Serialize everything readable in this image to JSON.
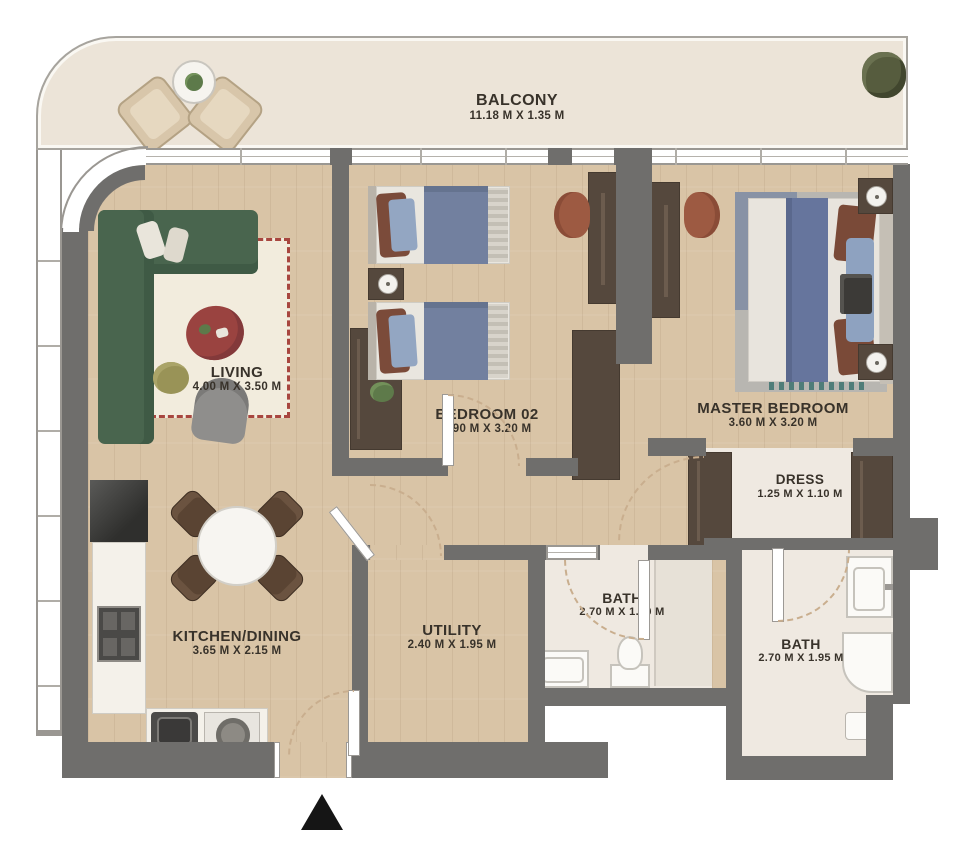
{
  "rooms": {
    "balcony": {
      "name": "BALCONY",
      "dims": "11.18 M X 1.35 M"
    },
    "living": {
      "name": "LIVING",
      "dims": "4.00 M X 3.50 M"
    },
    "bedroom02": {
      "name": "BEDROOM 02",
      "dims": "3.90 M X 3.20 M"
    },
    "master": {
      "name": "MASTER BEDROOM",
      "dims": "3.60 M X 3.20 M"
    },
    "dress": {
      "name": "DRESS",
      "dims": "1.25 M X 1.10 M"
    },
    "bath1": {
      "name": "BATH",
      "dims": "2.70 M X 1.50 M"
    },
    "bath2": {
      "name": "BATH",
      "dims": "2.70 M X 1.95 M"
    },
    "kitchen": {
      "name": "KITCHEN/DINING",
      "dims": "3.65 M X 2.15 M"
    },
    "utility": {
      "name": "UTILITY",
      "dims": "2.40 M X 1.95 M"
    }
  },
  "colors": {
    "wall": "#6f6e6c",
    "wood_floor": "#d9c4a6",
    "balcony_floor": "#ece4d8",
    "bath_floor": "#efe9e1",
    "sofa_green": "#49654e",
    "rug_border_red": "#a8463f",
    "coffee_table_red": "#9a4340",
    "bed_blue": "#72809f",
    "furniture_dark_brown": "#55483d",
    "chair_terracotta": "#9d5a42",
    "entrance_marker": "#151515"
  }
}
